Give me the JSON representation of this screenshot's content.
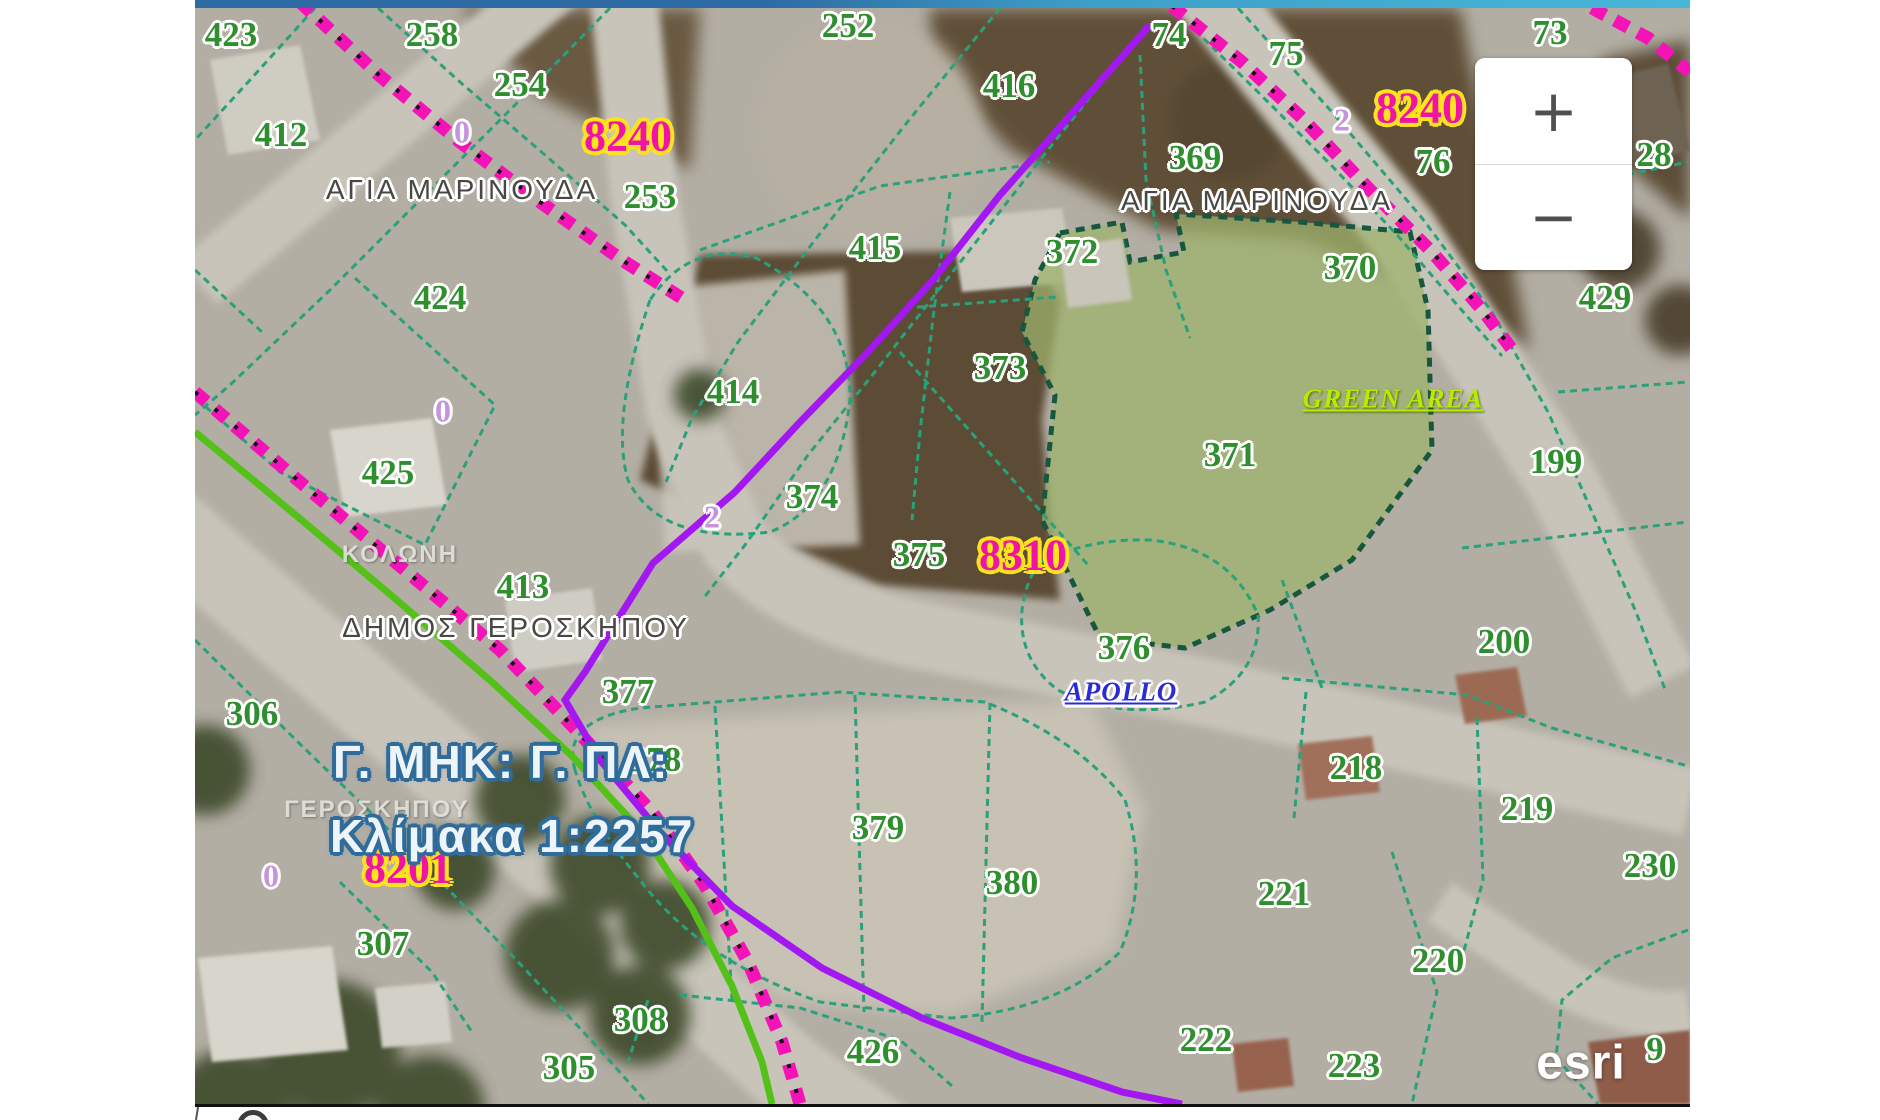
{
  "map": {
    "attribution": "esri",
    "partial_parcel_digit": "9",
    "title_text": "Γ. ΜΗΚ: Γ. ΠΛ:",
    "scale_text": "Κλίμακα 1:2257",
    "green_area_label": "GREEN AREA",
    "apollo_label": "APOLLO",
    "zoom_in_label": "+",
    "zoom_out_label": "−",
    "colors": {
      "parcel_number_green": "#2f8f2f",
      "reference_code_magenta": "#ef14a6",
      "reference_code_halo_yellow": "#ffe31e",
      "lot_number_lilac": "#c693dd",
      "cadastral_line_teal": "#2aa17b",
      "municipality_boundary_magenta": "#f413b6",
      "scheme_boundary_purple": "#a318f0",
      "road_boundary_green": "#54c118",
      "green_area_fill": "#9eb26c",
      "green_area_text": "#b6ec00",
      "apollo_text": "#2b2bd6",
      "scale_text_outline": "#2f6b9b",
      "top_strip_left": "#2e6ba5",
      "top_strip_right": "#47b7d9"
    },
    "parcel_labels": [
      {
        "text": "423",
        "x": 231,
        "y": 35
      },
      {
        "text": "258",
        "x": 432,
        "y": 35
      },
      {
        "text": "252",
        "x": 848,
        "y": 26
      },
      {
        "text": "74",
        "x": 1169,
        "y": 35
      },
      {
        "text": "75",
        "x": 1286,
        "y": 54
      },
      {
        "text": "73",
        "x": 1550,
        "y": 33
      },
      {
        "text": "254",
        "x": 520,
        "y": 85
      },
      {
        "text": "412",
        "x": 281,
        "y": 135
      },
      {
        "text": "416",
        "x": 1009,
        "y": 86
      },
      {
        "text": "369",
        "x": 1195,
        "y": 158
      },
      {
        "text": "76",
        "x": 1433,
        "y": 162
      },
      {
        "text": "28",
        "x": 1654,
        "y": 155
      },
      {
        "text": "253",
        "x": 650,
        "y": 197
      },
      {
        "text": "415",
        "x": 875,
        "y": 248
      },
      {
        "text": "372",
        "x": 1072,
        "y": 252
      },
      {
        "text": "370",
        "x": 1350,
        "y": 268
      },
      {
        "text": "429",
        "x": 1605,
        "y": 298
      },
      {
        "text": "424",
        "x": 440,
        "y": 298
      },
      {
        "text": "373",
        "x": 1000,
        "y": 368
      },
      {
        "text": "414",
        "x": 733,
        "y": 392
      },
      {
        "text": "425",
        "x": 388,
        "y": 473
      },
      {
        "text": "371",
        "x": 1230,
        "y": 455
      },
      {
        "text": "199",
        "x": 1556,
        "y": 462
      },
      {
        "text": "374",
        "x": 812,
        "y": 497
      },
      {
        "text": "375",
        "x": 919,
        "y": 555
      },
      {
        "text": "413",
        "x": 523,
        "y": 587
      },
      {
        "text": "376",
        "x": 1124,
        "y": 648
      },
      {
        "text": "200",
        "x": 1504,
        "y": 642
      },
      {
        "text": "377",
        "x": 628,
        "y": 692
      },
      {
        "text": "306",
        "x": 252,
        "y": 714
      },
      {
        "text": "378",
        "x": 655,
        "y": 760
      },
      {
        "text": "218",
        "x": 1356,
        "y": 768
      },
      {
        "text": "219",
        "x": 1527,
        "y": 809
      },
      {
        "text": "379",
        "x": 878,
        "y": 828
      },
      {
        "text": "230",
        "x": 1650,
        "y": 866
      },
      {
        "text": "380",
        "x": 1012,
        "y": 883
      },
      {
        "text": "221",
        "x": 1284,
        "y": 894
      },
      {
        "text": "307",
        "x": 383,
        "y": 944
      },
      {
        "text": "220",
        "x": 1438,
        "y": 961
      },
      {
        "text": "308",
        "x": 640,
        "y": 1020
      },
      {
        "text": "222",
        "x": 1206,
        "y": 1040
      },
      {
        "text": "426",
        "x": 873,
        "y": 1052
      },
      {
        "text": "223",
        "x": 1354,
        "y": 1066
      },
      {
        "text": "305",
        "x": 569,
        "y": 1068
      }
    ],
    "code_labels": [
      {
        "text": "8240",
        "x": 628,
        "y": 136
      },
      {
        "text": "8240",
        "x": 1420,
        "y": 108
      },
      {
        "text": "8310",
        "x": 1023,
        "y": 555
      },
      {
        "text": "8201",
        "x": 408,
        "y": 868
      }
    ],
    "lot_labels": [
      {
        "text": "0",
        "x": 462,
        "y": 132
      },
      {
        "text": "2",
        "x": 1342,
        "y": 120
      },
      {
        "text": "0",
        "x": 443,
        "y": 411
      },
      {
        "text": "2",
        "x": 712,
        "y": 517
      },
      {
        "text": "0",
        "x": 271,
        "y": 876
      }
    ],
    "district_labels": [
      {
        "text": "ΑΓΙΑ ΜΑΡΙΝΟΥΔΑ",
        "x": 462,
        "y": 190
      },
      {
        "text": "ΑΓΙΑ ΜΑΡΙΝΟΥΔΑ",
        "x": 1257,
        "y": 201
      },
      {
        "text": "ΔΗΜΟΣ ΓΕΡΟΣΚΗΠΟΥ",
        "x": 516,
        "y": 628
      }
    ],
    "faded_labels": [
      {
        "text": "ΚΟΛΩΝΗ",
        "x": 400,
        "y": 555
      },
      {
        "text": "ΓΕΡΟΣΚΗΠΟΥ",
        "x": 377,
        "y": 810
      }
    ]
  }
}
